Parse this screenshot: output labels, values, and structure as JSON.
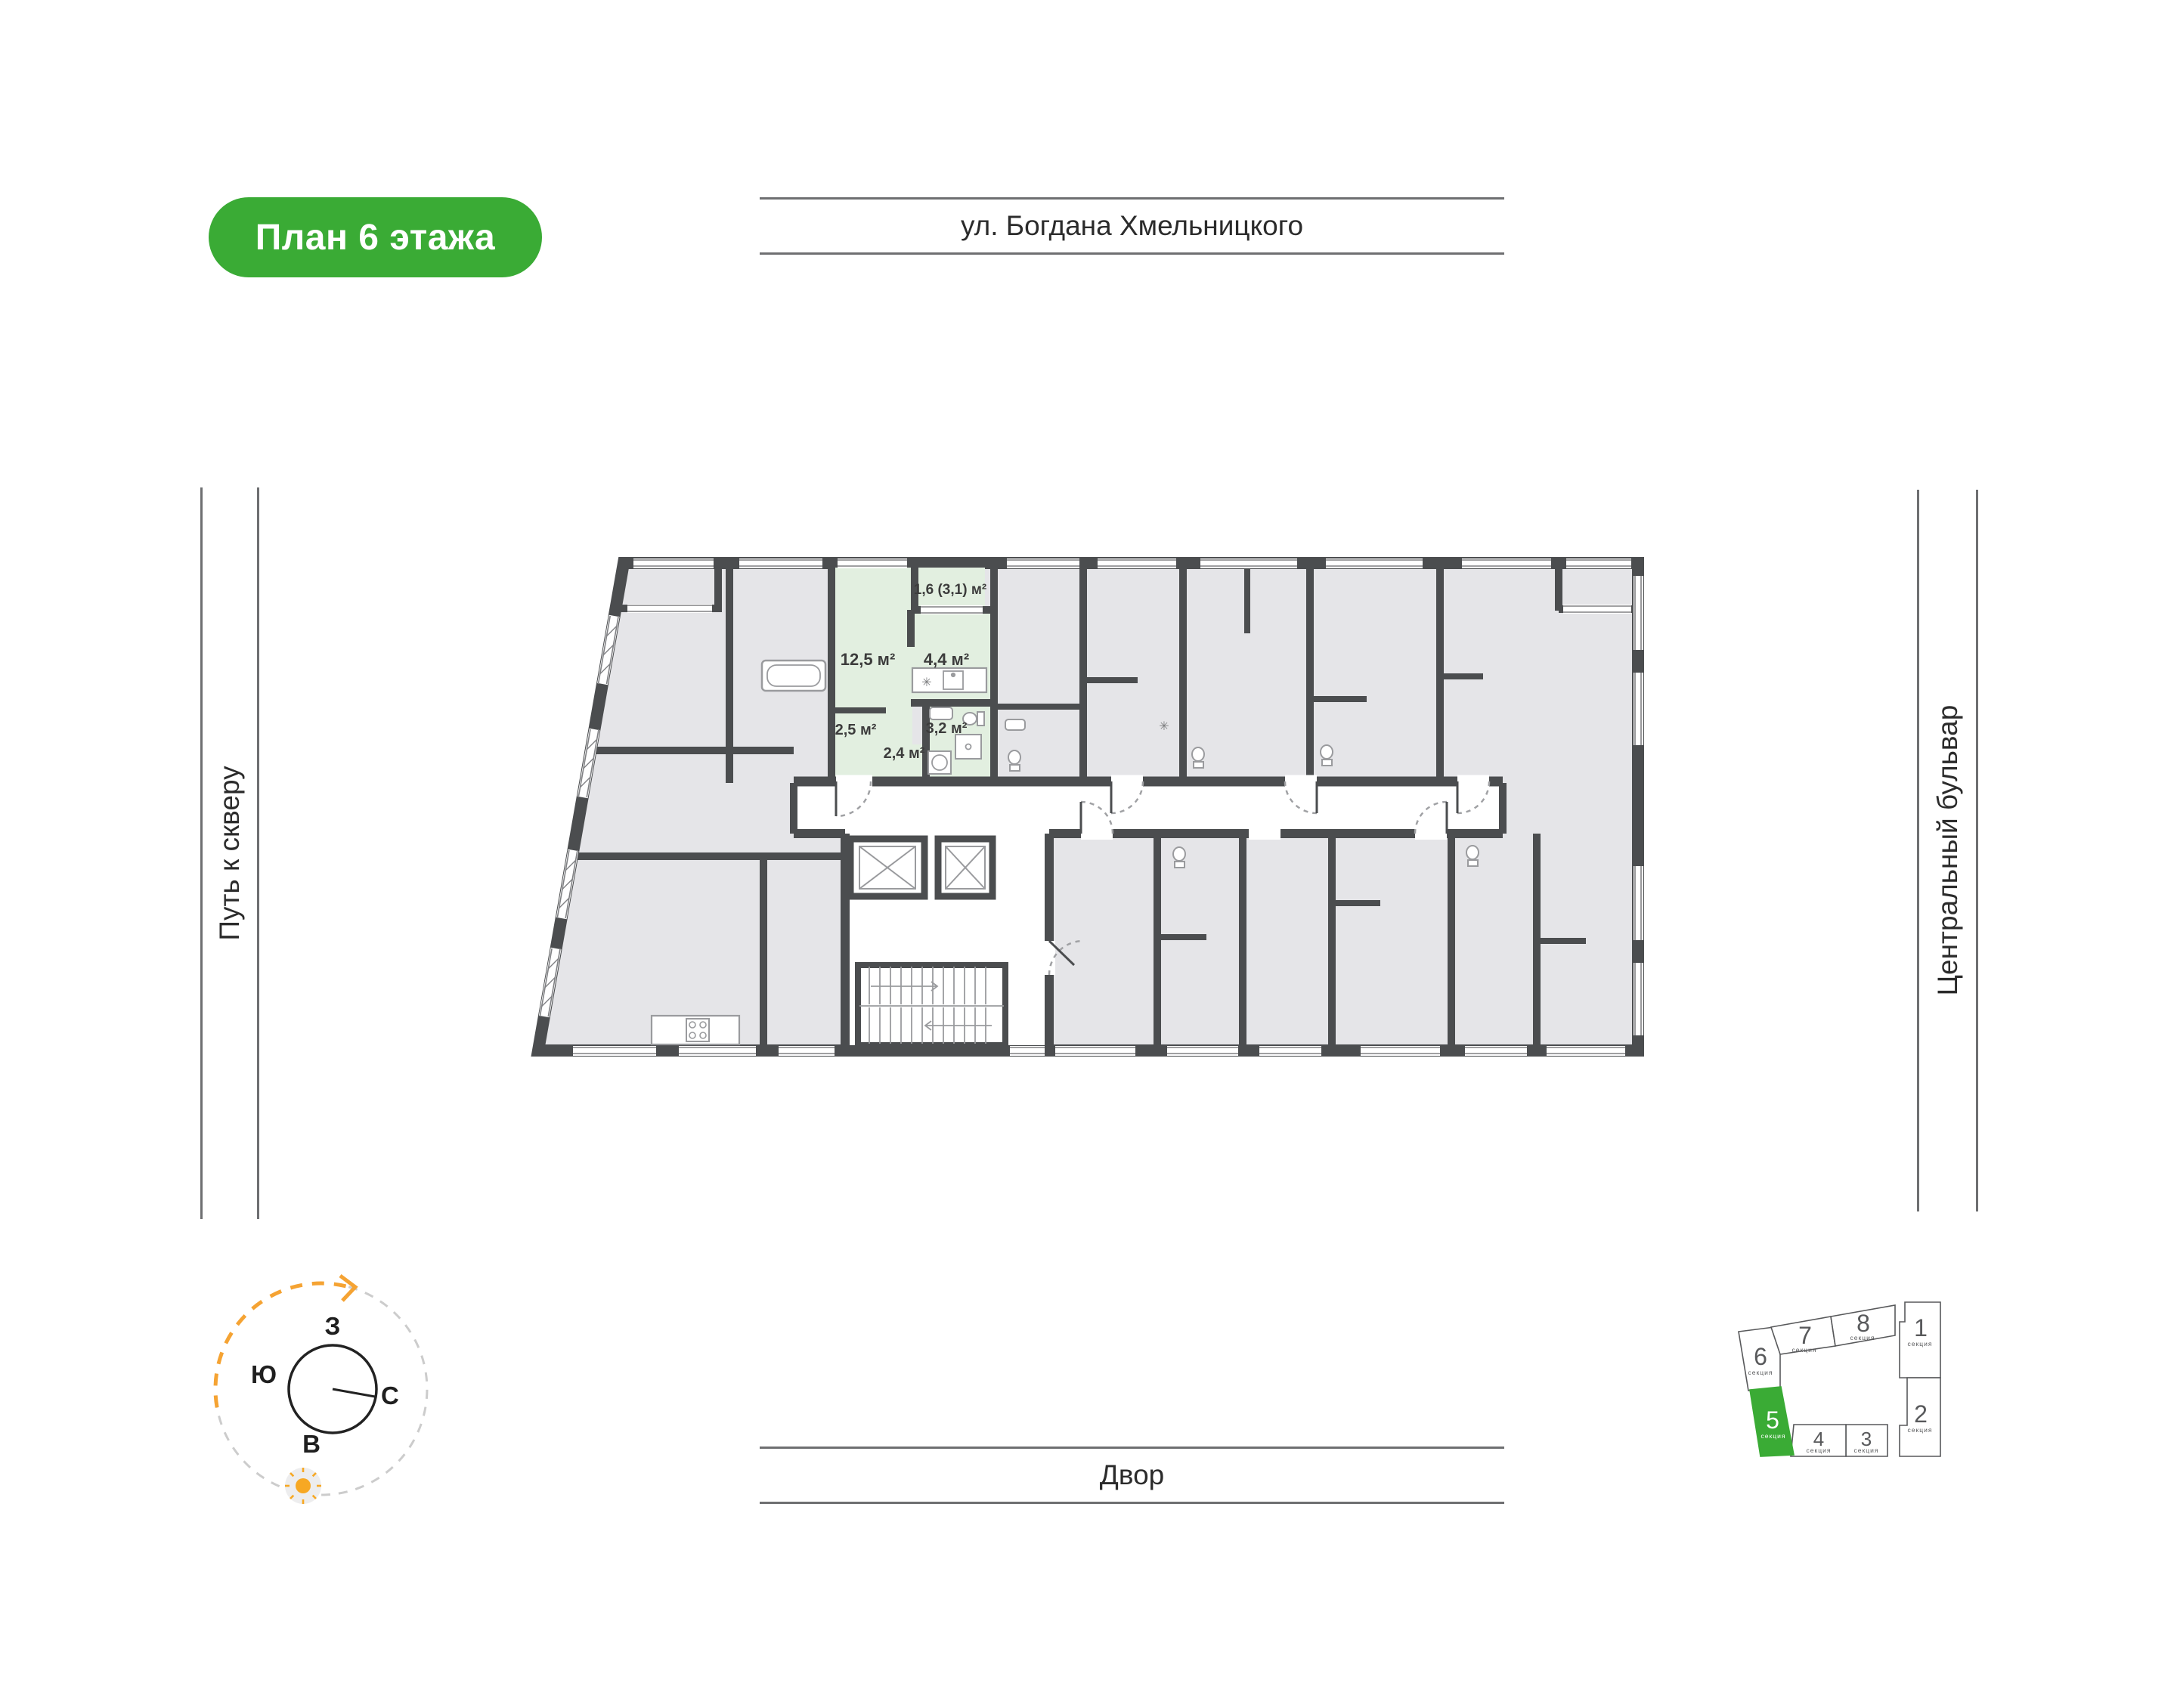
{
  "badge": {
    "label": "План 6 этажа"
  },
  "streets": {
    "top": "ул. Богдана Хмельницкого",
    "bottom": "Двор",
    "left": "Путь к скверу",
    "right": "Центральный бульвар"
  },
  "apartment": {
    "rooms": [
      {
        "name": "balcony",
        "area_label": "1,6 (3,1) м²"
      },
      {
        "name": "living",
        "area_label": "12,5 м²"
      },
      {
        "name": "kitchen",
        "area_label": "4,4 м²"
      },
      {
        "name": "hall",
        "area_label": "2,5 м²"
      },
      {
        "name": "bathroom",
        "area_label": "3,2 м²"
      },
      {
        "name": "corridor",
        "area_label": "2,4 м²"
      }
    ]
  },
  "compass": {
    "west": "З",
    "south": "Ю",
    "north": "С",
    "east": "В"
  },
  "minimap": {
    "sections": [
      {
        "num": "1",
        "label": "секция",
        "active": false
      },
      {
        "num": "2",
        "label": "секция",
        "active": false
      },
      {
        "num": "3",
        "label": "секция",
        "active": false
      },
      {
        "num": "4",
        "label": "секция",
        "active": false
      },
      {
        "num": "5",
        "label": "секция",
        "active": true
      },
      {
        "num": "6",
        "label": "секция",
        "active": false
      },
      {
        "num": "7",
        "label": "секция",
        "active": false
      },
      {
        "num": "8",
        "label": "секция",
        "active": false
      }
    ]
  },
  "symbols": {
    "asterisk": "✳"
  },
  "colors": {
    "accent_green": "#3aab35",
    "highlight_room": "#e2efe0",
    "wall": "#4b4d4f",
    "room_gray": "#e5e5e8",
    "sun_orange": "#f5a333"
  }
}
